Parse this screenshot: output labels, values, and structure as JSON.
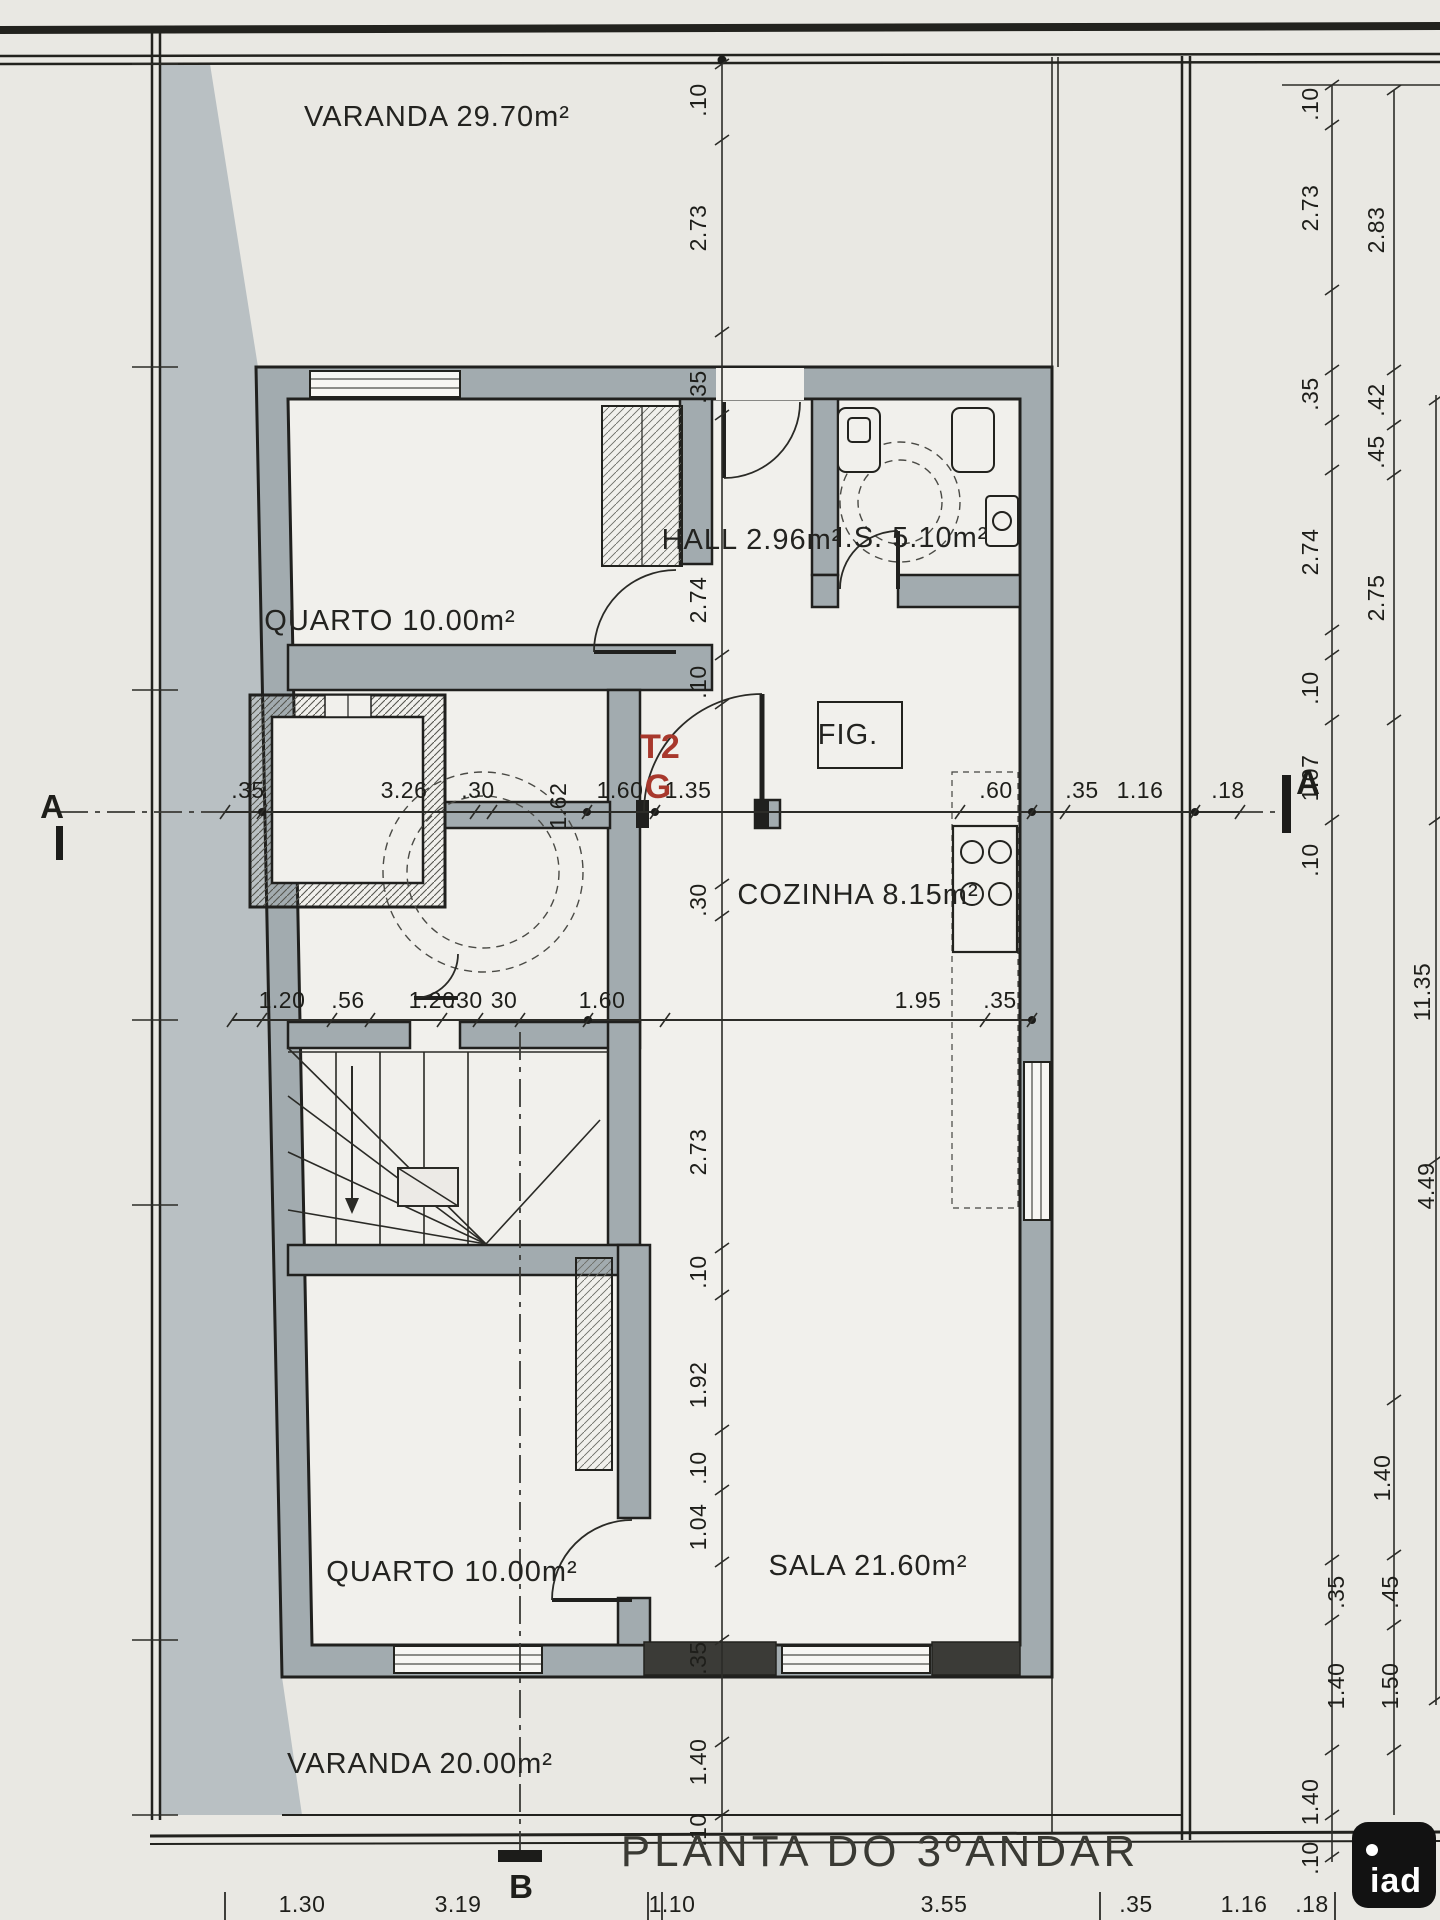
{
  "drawing": {
    "title": "PLANTA DO 3ºANDAR",
    "accent_red": "#a8382c",
    "unit_label": {
      "line1": "T2",
      "line2": "G"
    },
    "logo": {
      "text": "iad"
    },
    "rooms": [
      {
        "id": "room-label-varanda-top",
        "label": "VARANDA 29.70m²",
        "x": 437,
        "y": 126,
        "size": 30
      },
      {
        "id": "room-label-quarto-top",
        "label": "QUARTO 10.00m²",
        "x": 390,
        "y": 630,
        "size": 30
      },
      {
        "id": "room-label-hall",
        "label": "HALL 2.96m²",
        "x": 752,
        "y": 549,
        "size": 27
      },
      {
        "id": "room-label-is",
        "label": "I.S. 5.10m²",
        "x": 912,
        "y": 547,
        "size": 27
      },
      {
        "id": "room-label-cozinha",
        "label": "COZINHA 8.15m²",
        "x": 858,
        "y": 904,
        "size": 27
      },
      {
        "id": "room-label-fig",
        "label": "FIG.",
        "x": 848,
        "y": 744,
        "size": 21
      },
      {
        "id": "room-label-quarto-bottom",
        "label": "QUARTO 10.00m²",
        "x": 452,
        "y": 1581,
        "size": 30
      },
      {
        "id": "room-label-sala",
        "label": "SALA 21.60m²",
        "x": 868,
        "y": 1575,
        "size": 30
      },
      {
        "id": "room-label-varanda-bottom",
        "label": "VARANDA 20.00m²",
        "x": 420,
        "y": 1773,
        "size": 30
      }
    ],
    "markers": [
      {
        "id": "section-marker-a-left",
        "label": "A",
        "x": 52,
        "y": 818
      },
      {
        "id": "section-marker-a-right",
        "label": "A",
        "x": 1308,
        "y": 794
      },
      {
        "id": "section-marker-b",
        "label": "B",
        "x": 521,
        "y": 1898
      }
    ],
    "dims": {
      "center_chain": [
        {
          "t": ".10",
          "x": 706,
          "y": 100,
          "rot": 1
        },
        {
          "t": "2.73",
          "x": 706,
          "y": 228,
          "rot": 1
        },
        {
          "t": ".35",
          "x": 706,
          "y": 387,
          "rot": 1
        },
        {
          "t": "2.74",
          "x": 706,
          "y": 600,
          "rot": 1
        },
        {
          "t": ".10",
          "x": 706,
          "y": 682,
          "rot": 1
        },
        {
          "t": ".30",
          "x": 706,
          "y": 900,
          "rot": 1
        },
        {
          "t": "2.73",
          "x": 706,
          "y": 1152,
          "rot": 1
        },
        {
          "t": ".10",
          "x": 706,
          "y": 1272,
          "rot": 1
        },
        {
          "t": "1.92",
          "x": 706,
          "y": 1385,
          "rot": 1
        },
        {
          "t": ".10",
          "x": 706,
          "y": 1468,
          "rot": 1
        },
        {
          "t": "1.04",
          "x": 706,
          "y": 1527,
          "rot": 1
        },
        {
          "t": ".35",
          "x": 706,
          "y": 1658,
          "rot": 1
        },
        {
          "t": "1.40",
          "x": 706,
          "y": 1762,
          "rot": 1
        },
        {
          "t": ".10",
          "x": 706,
          "y": 1830,
          "rot": 1
        }
      ],
      "axis_row": [
        {
          "t": ".35",
          "x": 248,
          "y": 798
        },
        {
          "t": "3.26",
          "x": 404,
          "y": 798
        },
        {
          "t": ".30",
          "x": 478,
          "y": 798
        },
        {
          "t": "1.60",
          "x": 620,
          "y": 798
        },
        {
          "t": "1.35",
          "x": 688,
          "y": 798
        },
        {
          "t": ".60",
          "x": 996,
          "y": 798
        },
        {
          "t": ".35",
          "x": 1082,
          "y": 798
        },
        {
          "t": "1.16",
          "x": 1140,
          "y": 798
        },
        {
          "t": ".18",
          "x": 1228,
          "y": 798
        }
      ],
      "mid_row": [
        {
          "t": "1.20",
          "x": 282,
          "y": 1008
        },
        {
          "t": ".56",
          "x": 348,
          "y": 1008
        },
        {
          "t": "1.20",
          "x": 432,
          "y": 1008
        },
        {
          "t": ".30",
          "x": 466,
          "y": 1008
        },
        {
          "t": "30",
          "x": 504,
          "y": 1008
        },
        {
          "t": "1.60",
          "x": 602,
          "y": 1008
        },
        {
          "t": "1.95",
          "x": 918,
          "y": 1008
        },
        {
          "t": ".35",
          "x": 1000,
          "y": 1008
        }
      ],
      "vestibule": [
        {
          "t": "1.62",
          "x": 566,
          "y": 806,
          "rot": 1
        }
      ],
      "right_inner_chain": [
        {
          "t": ".10",
          "x": 1318,
          "y": 104,
          "rot": 1
        },
        {
          "t": "2.73",
          "x": 1318,
          "y": 208,
          "rot": 1
        },
        {
          "t": ".35",
          "x": 1318,
          "y": 394,
          "rot": 1
        },
        {
          "t": "2.74",
          "x": 1318,
          "y": 552,
          "rot": 1
        },
        {
          "t": ".10",
          "x": 1318,
          "y": 688,
          "rot": 1
        },
        {
          "t": "1.07",
          "x": 1318,
          "y": 778,
          "rot": 1
        },
        {
          "t": ".10",
          "x": 1318,
          "y": 860,
          "rot": 1
        },
        {
          "t": ".35",
          "x": 1344,
          "y": 1592,
          "rot": 1
        },
        {
          "t": "1.40",
          "x": 1344,
          "y": 1686,
          "rot": 1
        },
        {
          "t": "1.40",
          "x": 1318,
          "y": 1802,
          "rot": 1
        },
        {
          "t": ".10",
          "x": 1318,
          "y": 1858,
          "rot": 1
        }
      ],
      "right_outer_chain": [
        {
          "t": "2.83",
          "x": 1384,
          "y": 230,
          "rot": 1
        },
        {
          "t": ".42",
          "x": 1384,
          "y": 400,
          "rot": 1
        },
        {
          "t": ".45",
          "x": 1384,
          "y": 452,
          "rot": 1
        },
        {
          "t": "2.75",
          "x": 1384,
          "y": 598,
          "rot": 1
        },
        {
          "t": "1.40",
          "x": 1390,
          "y": 1478,
          "rot": 1
        },
        {
          "t": ".45",
          "x": 1398,
          "y": 1592,
          "rot": 1
        },
        {
          "t": "1.50",
          "x": 1398,
          "y": 1686,
          "rot": 1
        }
      ],
      "right_edge_chain": [
        {
          "t": "11.35",
          "x": 1430,
          "y": 992,
          "rot": 1
        },
        {
          "t": "4.49",
          "x": 1434,
          "y": 1186,
          "rot": 1
        }
      ],
      "bottom_row": [
        {
          "t": "1.30",
          "x": 302,
          "y": 1912
        },
        {
          "t": "3.19",
          "x": 458,
          "y": 1912
        },
        {
          "t": "1.10",
          "x": 672,
          "y": 1912
        },
        {
          "t": "3.55",
          "x": 944,
          "y": 1912
        },
        {
          "t": ".35",
          "x": 1136,
          "y": 1912
        },
        {
          "t": "1.16",
          "x": 1244,
          "y": 1912
        },
        {
          "t": ".18",
          "x": 1312,
          "y": 1912
        }
      ]
    }
  }
}
